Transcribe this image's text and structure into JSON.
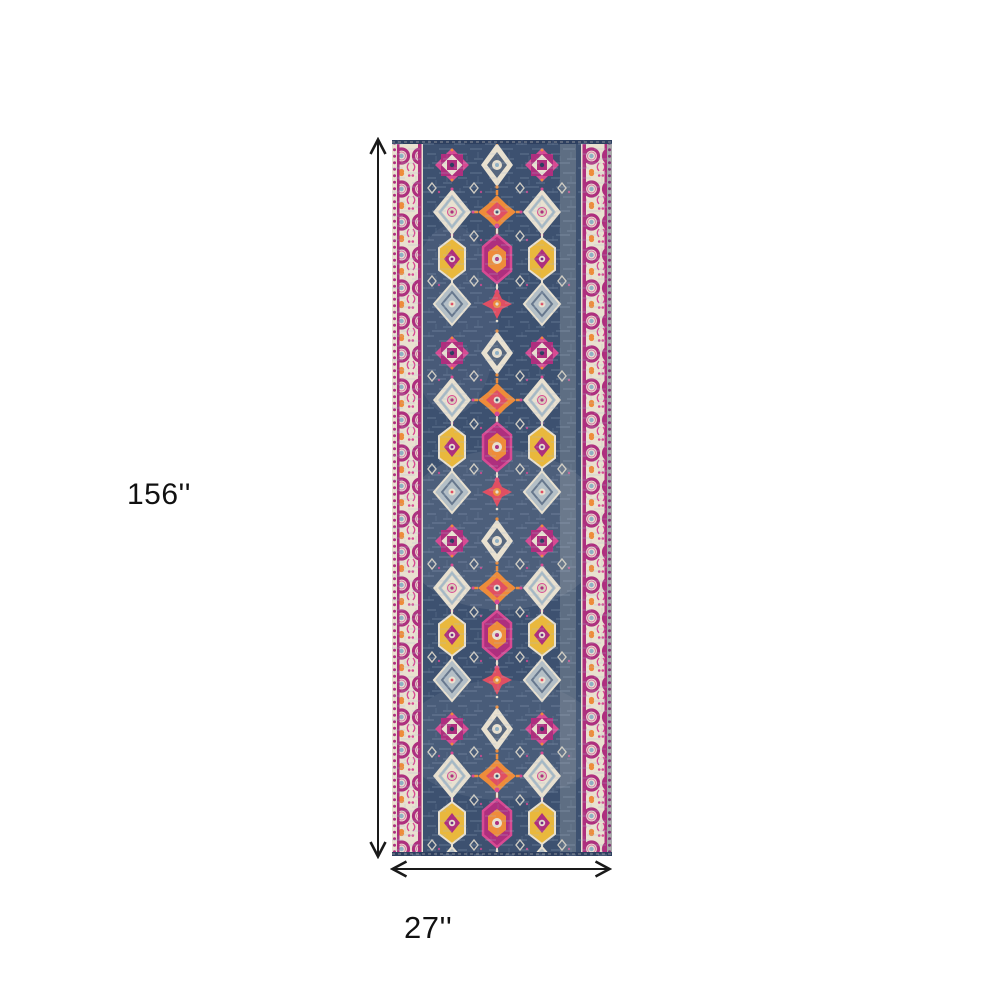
{
  "dimensions": {
    "height_label": "156''",
    "width_label": "27''"
  },
  "colors": {
    "bg": "#ffffff",
    "navy": "#3d5170",
    "navydark": "#2e4060",
    "cream": "#e9e1d0",
    "creamdark": "#d8cfba",
    "magenta": "#ae2f7e",
    "pink": "#d84a93",
    "red": "#e04f63",
    "orange": "#ee8c3a",
    "yellow": "#e9b83d",
    "blue": "#8fb0c4",
    "gray": "#b4bfc6",
    "arrow": "#1a1a1a",
    "text": "#111111"
  }
}
